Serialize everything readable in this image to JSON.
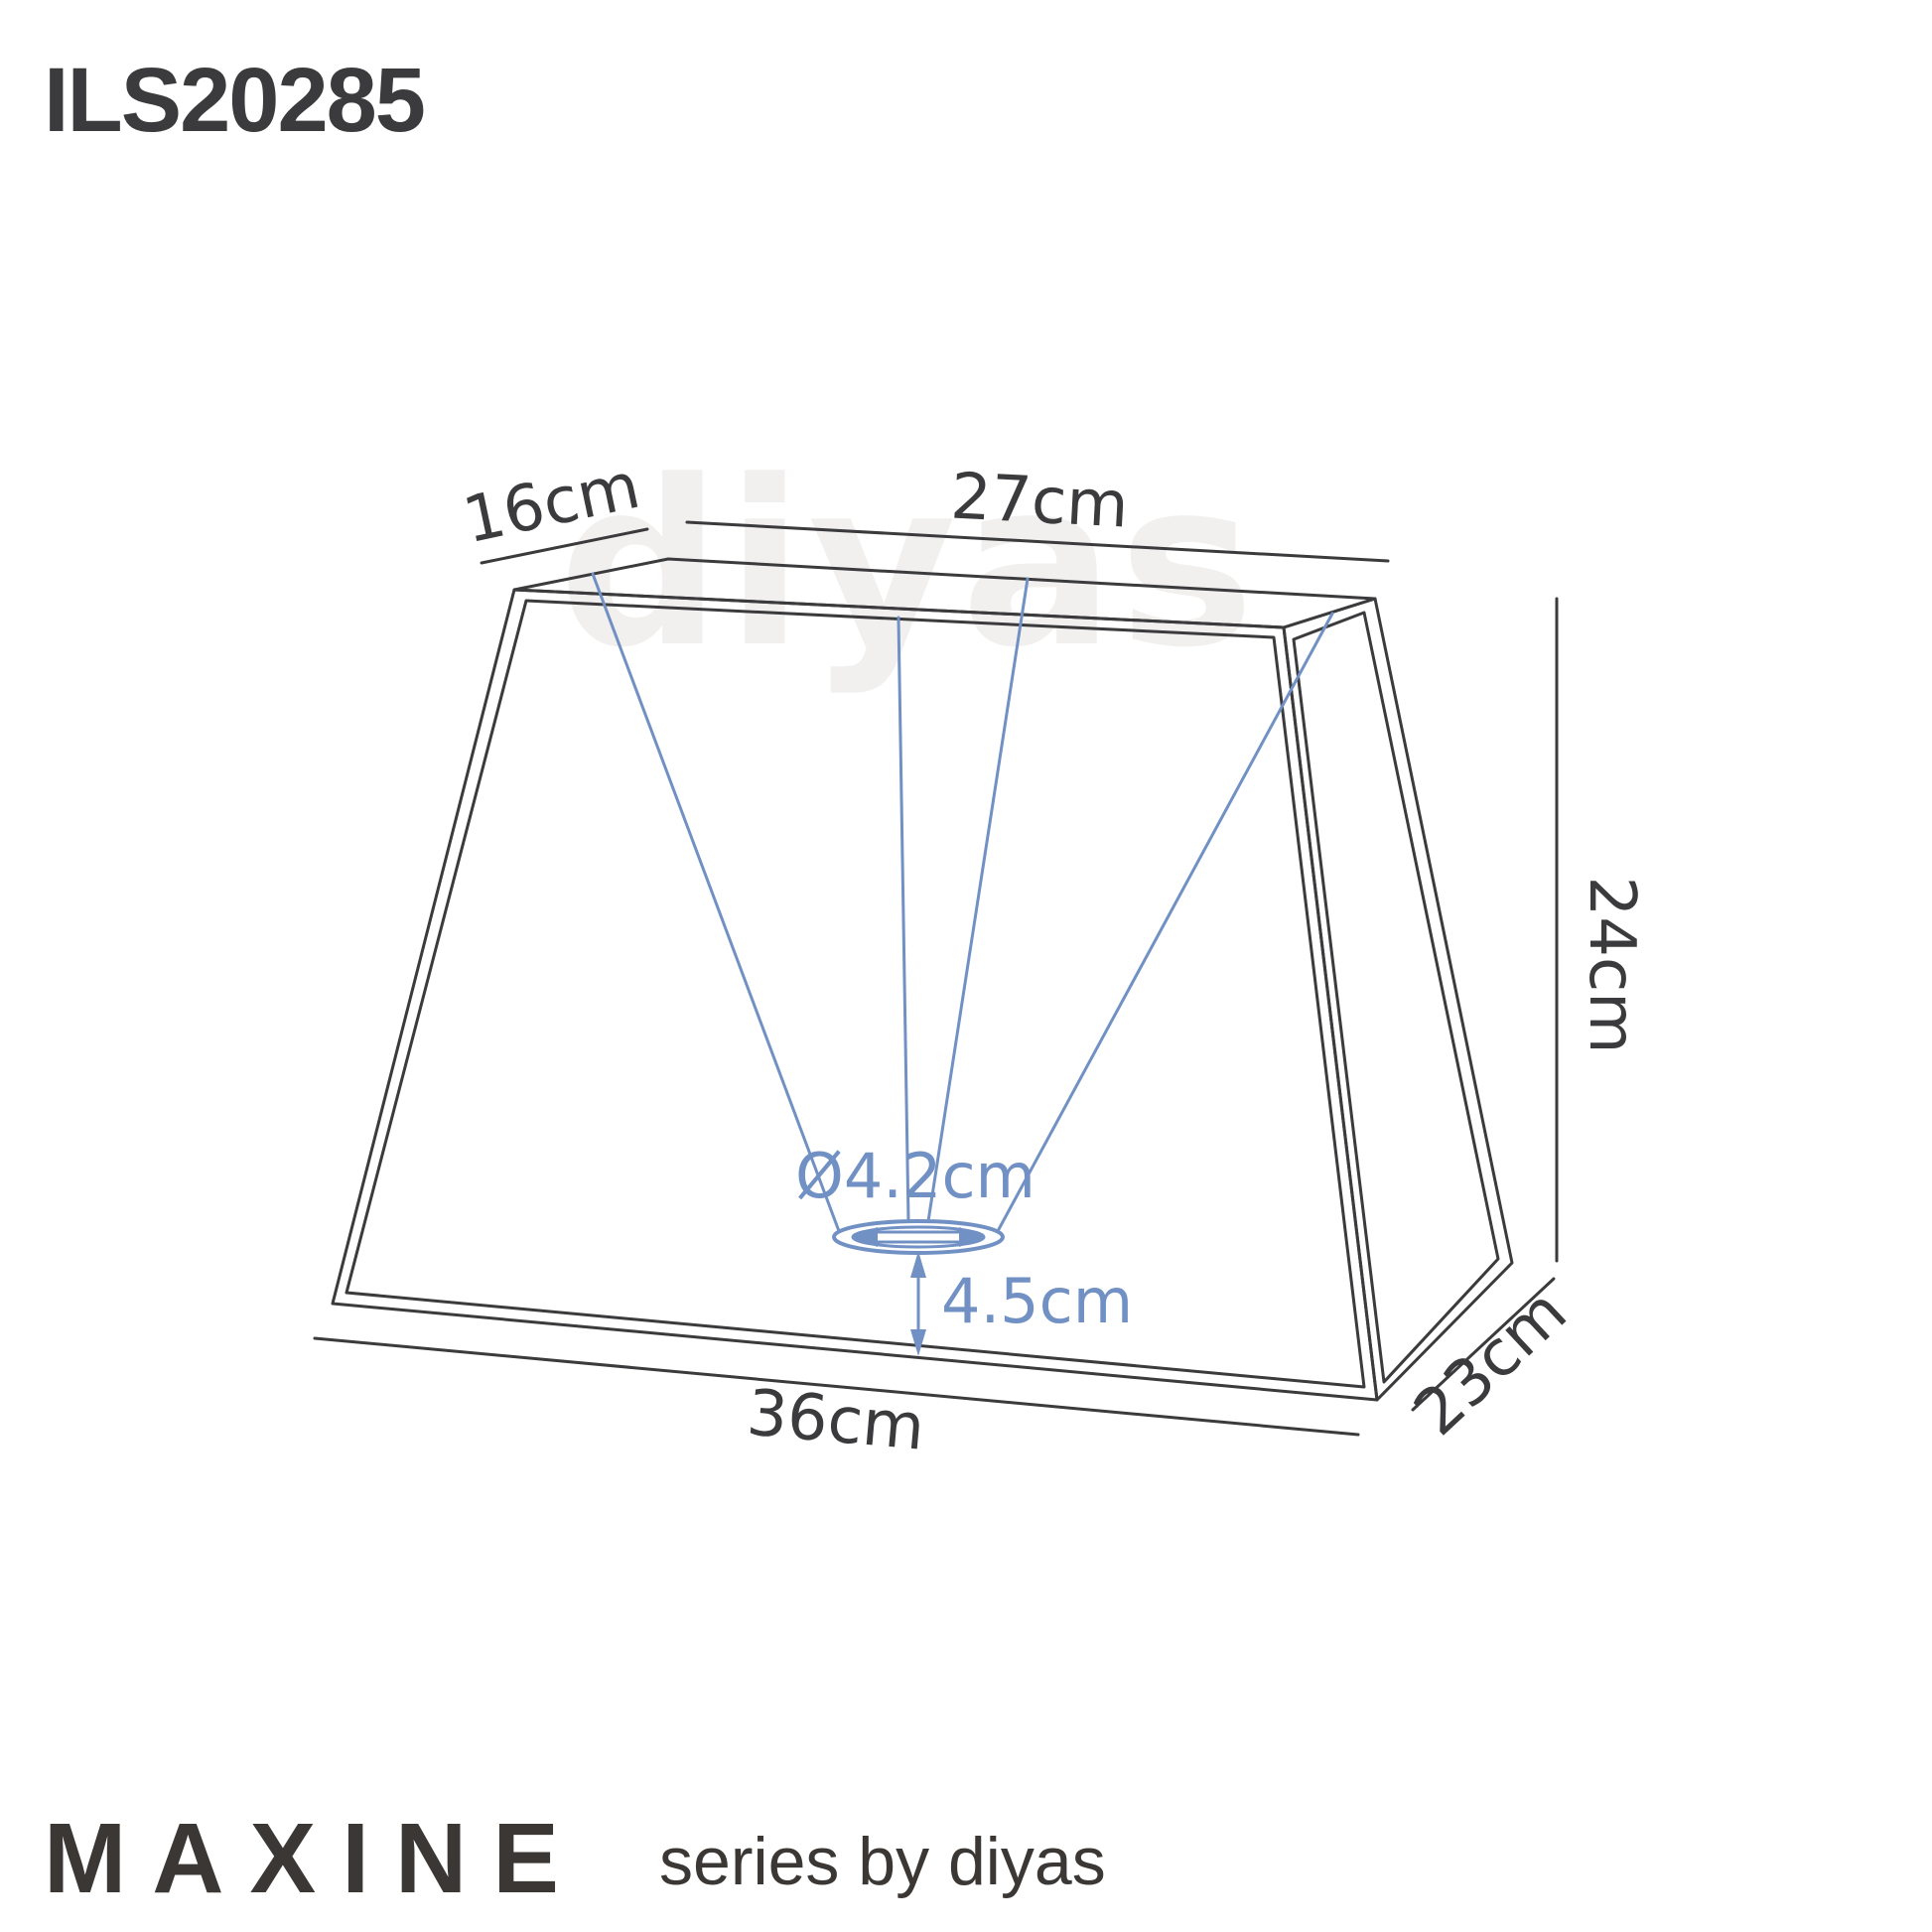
{
  "product": {
    "code": "ILS20285"
  },
  "watermark": {
    "text": "diyas"
  },
  "footer": {
    "series_name": "MAXINE",
    "byline": "series by diyas"
  },
  "colors": {
    "line": "#3b3b3d",
    "accent_blue": "#7191c4",
    "watermark": "#f1f0ee",
    "background": "#ffffff"
  },
  "dimensions": {
    "top_depth": "16cm",
    "top_width": "27cm",
    "height": "24cm",
    "bottom_width": "36cm",
    "bottom_depth": "23cm",
    "fitter_diameter": "Ø4.2cm",
    "fitter_recess": "4.5cm"
  }
}
